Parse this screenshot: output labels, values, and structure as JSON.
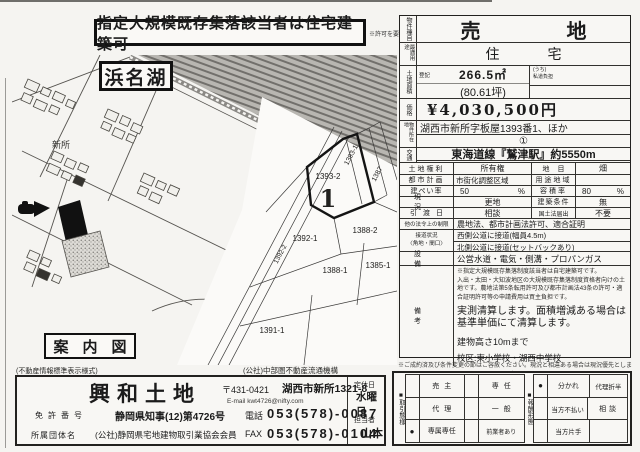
{
  "banner": {
    "text": "指定大規模既存集落該当者は住宅建築可",
    "note": "※許可を要す"
  },
  "map": {
    "lake_label": "浜名湖",
    "district_label": "新所",
    "caption": "案内図",
    "parcels": {
      "main": "1393-2",
      "main_mark": "1",
      "p1393_1": "1393-1",
      "p1387": "1387",
      "p1388_2": "1388-2",
      "p1392_1": "1392-1",
      "p1392_2": "1392-2",
      "p1388_1": "1388-1",
      "p1385_1": "1385-1",
      "p1391_1": "1391-1"
    }
  },
  "details": {
    "type_label": "物件種目",
    "type_value": "売地",
    "use_label": "最適用途",
    "use_value": "住宅",
    "area_label": "土地面積",
    "area_reg_label": "登記",
    "area_value": "266.5㎡",
    "area_tsubo": "(80.61坪)",
    "private_road_line1": "(うち)",
    "private_road_line2": "私道負担",
    "price_label": "価格",
    "price_value": "¥4,030,500円",
    "loc_label": "物件所在地",
    "loc_value": "湖西市新所字板屋1393番1、ほか",
    "loc_mark": "①",
    "access_label": "交通",
    "access_value": "東海道線『鷲津駅』約5550m",
    "rights_label": "土地権利",
    "rights_value": "所有権",
    "chimoku_label": "地目",
    "chimoku_value": "畑",
    "plan_label": "都市計画",
    "plan_value": "市街化調整区域",
    "zone_label": "用途地域",
    "zone_value": "",
    "bcr_label": "建ぺい率",
    "bcr_value": "50",
    "unit_percent": "%",
    "far_label": "容積率",
    "far_value": "80",
    "genkyo_label": "現況",
    "genkyo_value": "更地",
    "joken_label": "建築条件",
    "joken_value": "無",
    "hikiwatashi_label": "引渡日",
    "hikiwatashi_value": "相談",
    "kokudo_label": "国土法届出",
    "kokudo_value": "不要",
    "laws_label": "他の法令上の制限",
    "laws_value": "農地法、都市計画法許可、適合証明",
    "road_label1": "接道状況",
    "road_label2": "〈角地・間口〉",
    "road_value1": "西側公道に接道(幅員4.5m)",
    "road_value2": "北側公道に接道(セットバックあり)",
    "util_label": "設備",
    "util_value": "公営水道・電気・側溝・プロパンガス",
    "remarks_label": "備考",
    "remarks_small1": "※指定大規模既存集落制度該当者は自宅建築可です。",
    "remarks_small2": "入出・太田・大知波地区の大規模既存集落制度資格者向けの土地です。農地法第5条転用許可及び都市計画法43条の許可・適合証明許可等の申請費用は買主負担です。",
    "remarks_main": "実測清算します。面積増減ある場合は基準単価にて清算します。",
    "remarks_height": "建物高さ10mまで",
    "remarks_school": "校区:東小学校・湖西中学校"
  },
  "footer_note": "※ご成約済及び条件変更の節はご容赦ください。現況と相違ある場合は現況優先とします。",
  "standards_note": "(不動産情報標準表示様式)",
  "org_note": "(公社)中部圏不動産流通機構",
  "agency": {
    "name": "興和土地",
    "postal": "〒431-0421",
    "address": "湖西市新所1321-8",
    "email": "E-mail kwt4726@nifty.com",
    "license_label": "免許番号",
    "license_value": "静岡県知事(12)第4726号",
    "tel_label": "電話",
    "tel_value": "053(578)-0087",
    "member_label": "所属団体名",
    "member_value": "(公社)静岡県宅地建物取引業協会会員",
    "fax_label": "FAX",
    "fax_value": "053(578)-0104",
    "closed_label": "定休日",
    "closed_value": "水曜日",
    "staff_label": "担当者",
    "staff_value": "山本"
  },
  "stamp": {
    "bullet": "■",
    "mark": "●",
    "deal_label": "取引態様",
    "opt_seller": "売主",
    "opt_agent": "代理",
    "opt_exclusive": "専属専任",
    "opt_senin": "専任",
    "opt_general": "一般",
    "opt_prior": "前業者あり",
    "fee_label": "報酬形態",
    "opt_wakare": "分かれ",
    "opt_dairiseppan": "代理折半",
    "opt_fubarai": "当方不払い",
    "opt_soudan": "相談",
    "opt_katate": "当方片手"
  }
}
